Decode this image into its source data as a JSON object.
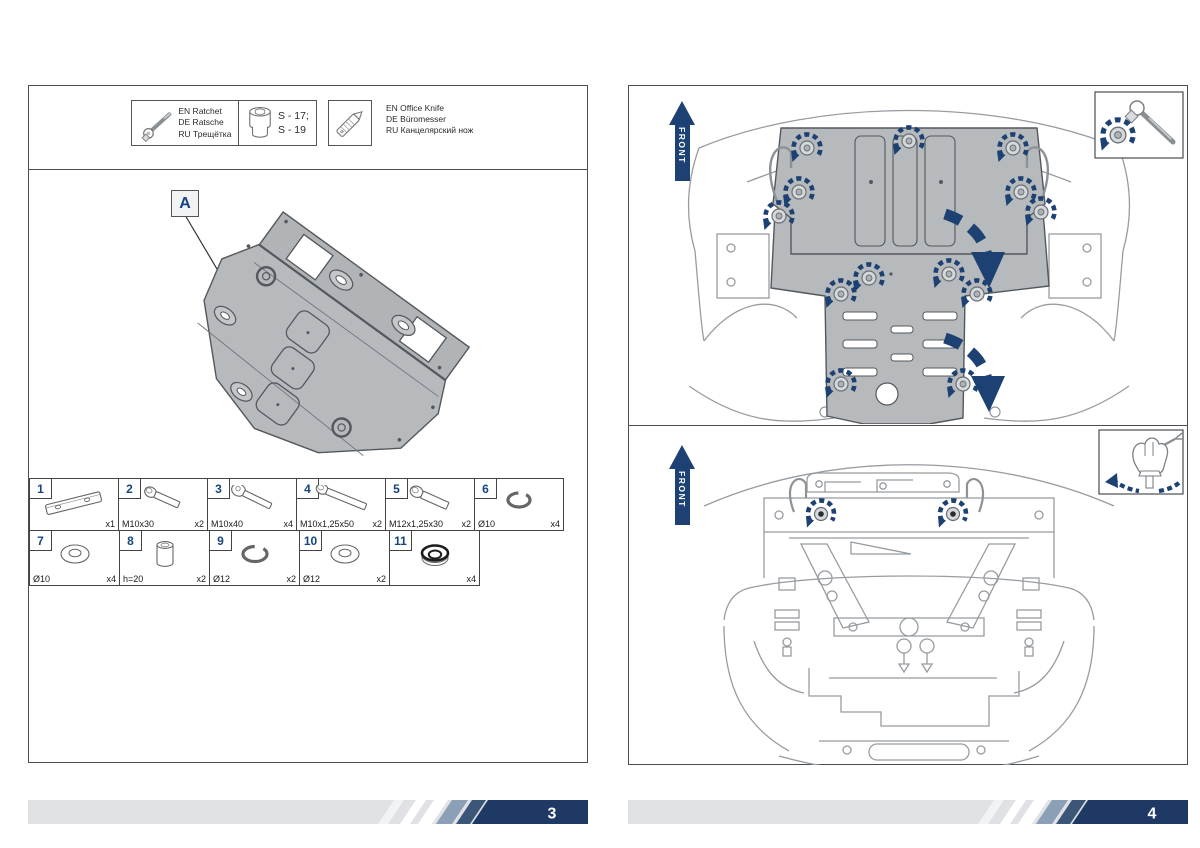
{
  "meta": {
    "colors": {
      "navy_accent": "#1d4173",
      "footer_navy": "#1e3a64",
      "footer_steel": "#8ba0b6",
      "footer_dark_stripe": "#3c5678",
      "footer_bar": "#dfe1e4",
      "plate_gray": "#b6babd",
      "line_gray": "#979ca1"
    }
  },
  "tools": {
    "ratchet": {
      "lines": [
        "EN Ratchet",
        "DE Ratsche",
        "RU Трещётка"
      ]
    },
    "socket": {
      "sizes": [
        "S - 17;",
        "S - 19"
      ]
    },
    "knife": {
      "lines": [
        "EN Office Knife",
        "DE Büromesser",
        "RU Канцелярский нож"
      ]
    }
  },
  "diagram": {
    "callout_label": "A"
  },
  "labels": {
    "front": "FRONT"
  },
  "parts": {
    "items": [
      {
        "num": "1",
        "size": "",
        "qty": "x1"
      },
      {
        "num": "2",
        "size": "M10x30",
        "qty": "x2"
      },
      {
        "num": "3",
        "size": "M10x40",
        "qty": "x4"
      },
      {
        "num": "4",
        "size": "M10x1,25x50",
        "qty": "x2"
      },
      {
        "num": "5",
        "size": "M12x1,25x30",
        "qty": "x2"
      },
      {
        "num": "6",
        "size": "Ø10",
        "qty": "x4"
      },
      {
        "num": "7",
        "size": "Ø10",
        "qty": "x4"
      },
      {
        "num": "8",
        "size": "h=20",
        "qty": "x2"
      },
      {
        "num": "9",
        "size": "Ø12",
        "qty": "x2"
      },
      {
        "num": "10",
        "size": "Ø12",
        "qty": "x2"
      },
      {
        "num": "11",
        "size": "",
        "qty": "x4"
      }
    ]
  },
  "footer": {
    "left_page_number": "3",
    "right_page_number": "4"
  }
}
